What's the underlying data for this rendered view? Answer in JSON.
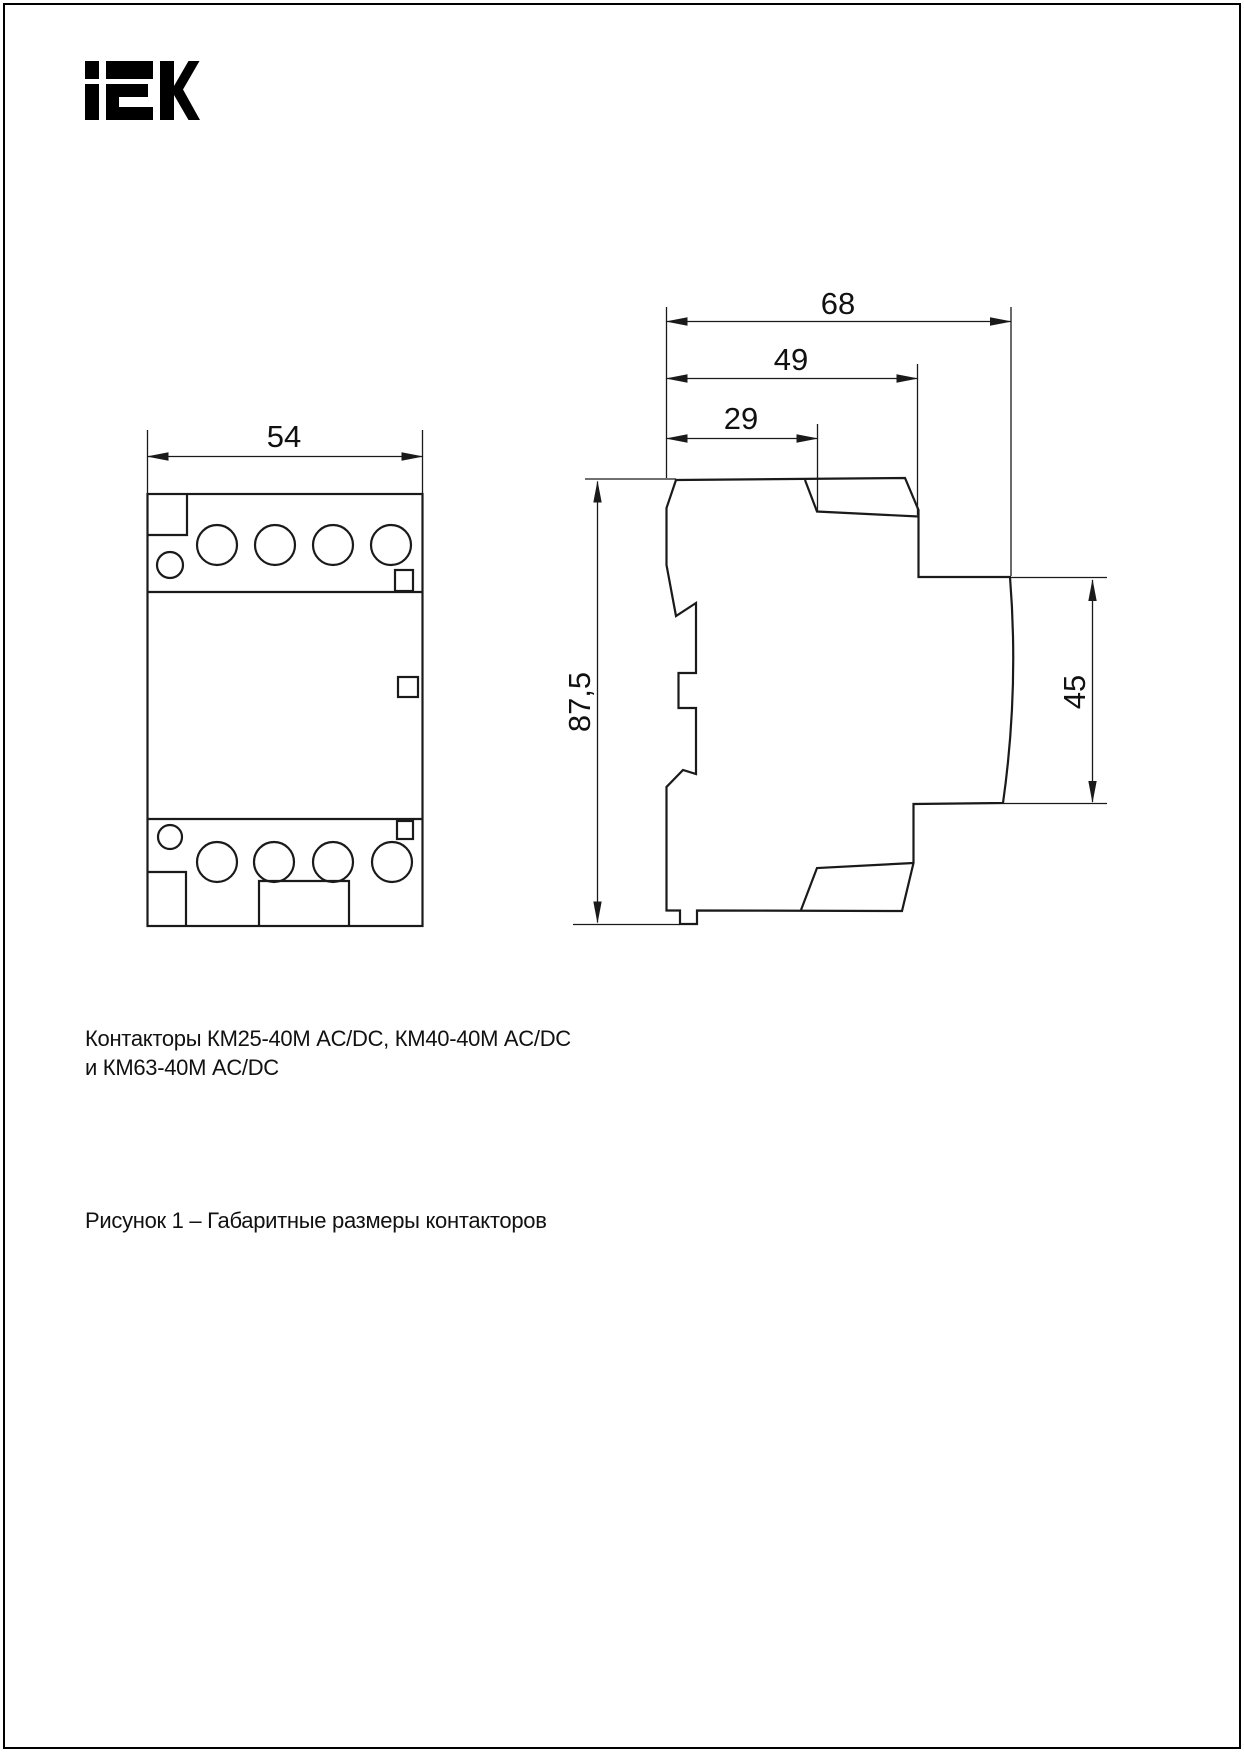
{
  "logo": {
    "brand": "iEK"
  },
  "colors": {
    "line": "#1a1a1a",
    "text": "#111111",
    "logo": "#000000",
    "page_border": "#000000"
  },
  "front_view": {
    "dim_width": "54"
  },
  "side_view": {
    "dim_overall_width": "68",
    "dim_cover_width": "49",
    "dim_top_step_width": "29",
    "dim_overall_height": "87,5",
    "dim_terminal_height": "45"
  },
  "captions": {
    "products_line1": "Контакторы КМ25-40М AC/DC, КМ40-40М AC/DC",
    "products_line2": "и КМ63-40М AC/DC",
    "figure": "Рисунок 1 – Габаритные размеры контакторов"
  }
}
